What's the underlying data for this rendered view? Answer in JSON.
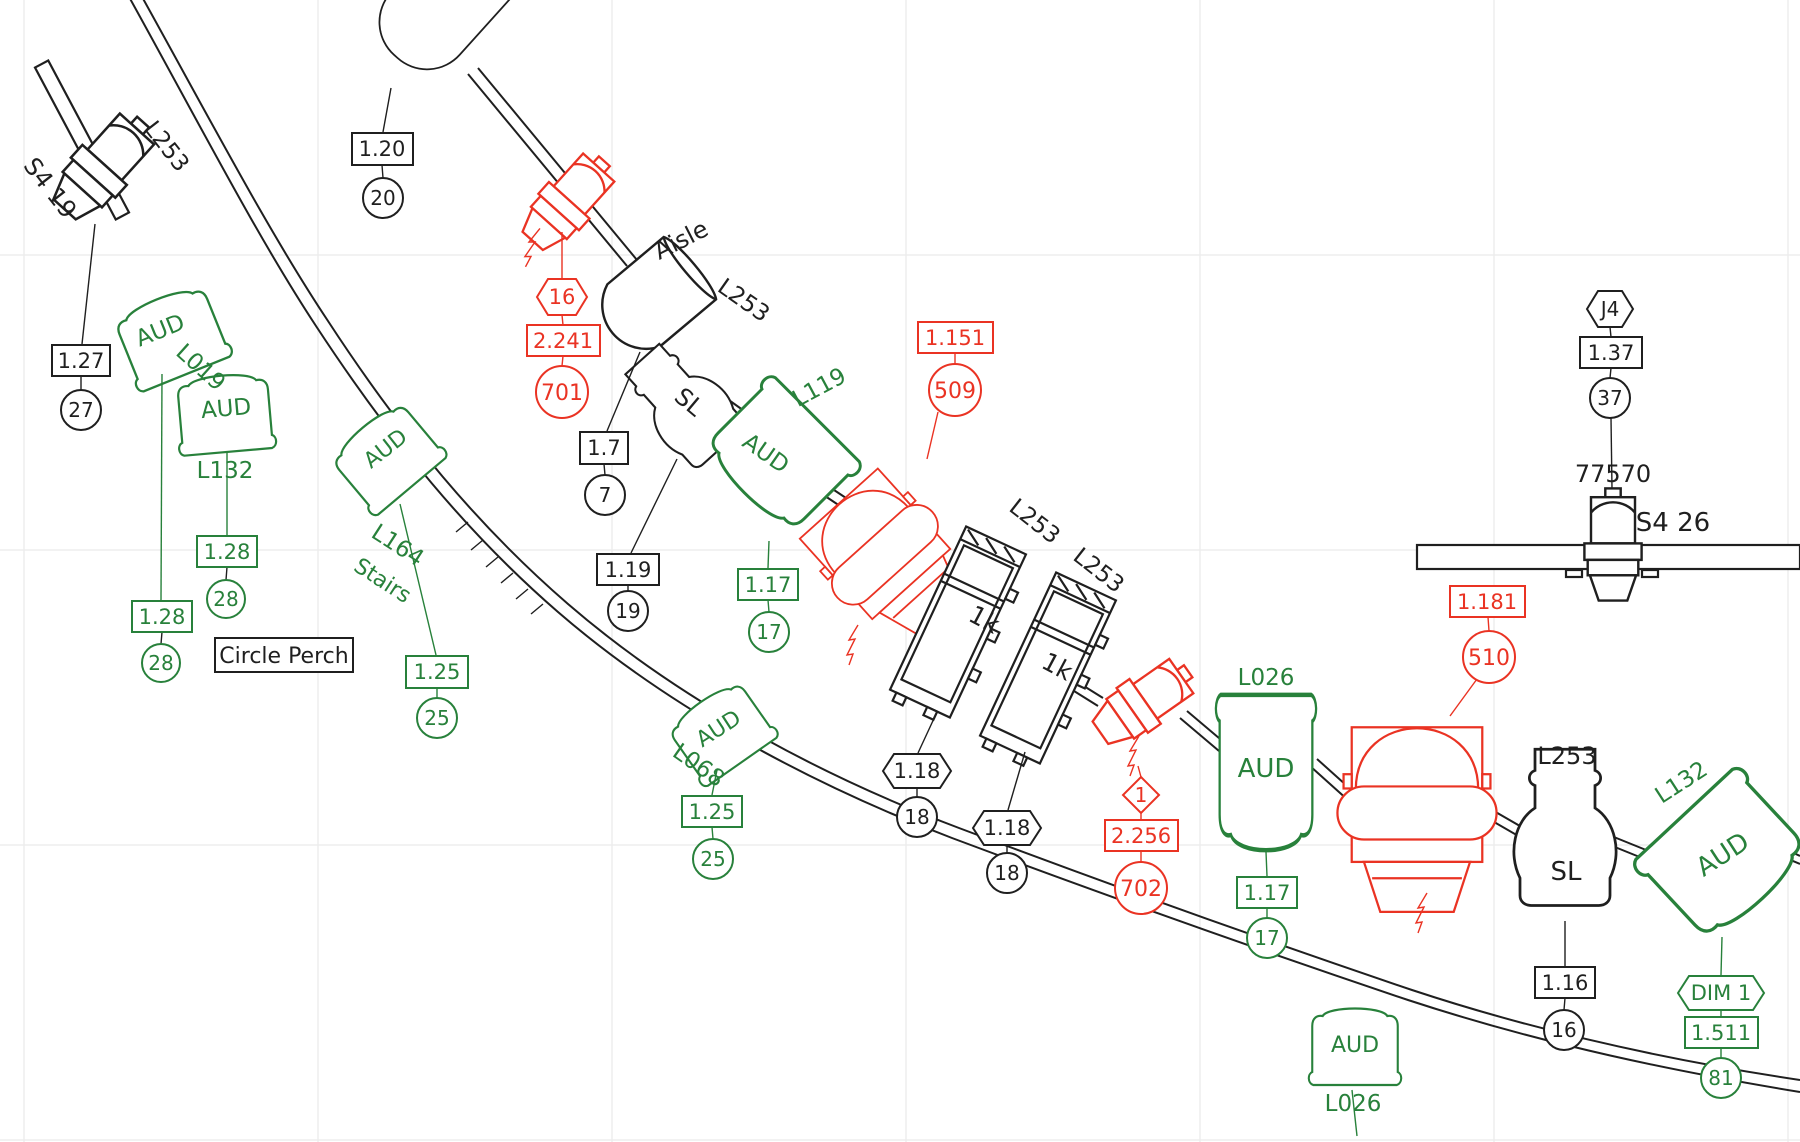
{
  "colors": {
    "background": "#ffffff",
    "black_linework": "#1f1f1f",
    "green_fixtures": "#28813b",
    "red_fixtures": "#ea3323",
    "grid": "#ededed"
  },
  "annotations": {
    "circle_perch": "Circle Perch",
    "aisle": "Aisle"
  },
  "fixtures": {
    "s4_19": {
      "label": "S4 19",
      "gel": "L253",
      "channel": "1.27",
      "unit": "27"
    },
    "spot_top": {
      "channel": "1.20",
      "unit": "20"
    },
    "aud_l019": {
      "type": "AUD",
      "position": "L019",
      "channel": "1.28",
      "unit": "28"
    },
    "aud_l132_left": {
      "type": "AUD",
      "position": "L132",
      "channel": "1.28",
      "unit": "28"
    },
    "aud_l164": {
      "type": "AUD",
      "position_line1": "L164",
      "position_line2": "Stairs",
      "channel": "1.25",
      "unit": "25"
    },
    "aud_l068": {
      "type": "AUD",
      "position": "L068",
      "channel": "1.25",
      "unit": "25"
    },
    "aud_l119": {
      "type": "AUD",
      "position": "L119",
      "channel": "1.17",
      "unit": "17"
    },
    "aud_l026_right": {
      "type": "AUD",
      "position": "L026",
      "channel": "1.17",
      "unit": "17"
    },
    "aud_l026_bottom": {
      "type": "AUD",
      "position": "L026"
    },
    "aud_l132_right": {
      "type": "AUD",
      "position": "L132",
      "dimmer": "DIM 1",
      "channel": "1.511",
      "unit": "81"
    },
    "red_701": {
      "dimmer": "16",
      "channel": "2.241",
      "unit": "701"
    },
    "red_702": {
      "dimmer": "1",
      "channel": "2.256",
      "unit": "702"
    },
    "mover_509": {
      "channel": "1.151",
      "unit": "509"
    },
    "mover_510": {
      "channel": "1.181",
      "unit": "510"
    },
    "sl_aisle": {
      "gel": "L253",
      "type": "SL",
      "channel_a": "1.7",
      "unit_a": "7",
      "channel_b": "1.19",
      "unit_b": "19"
    },
    "onek_a": {
      "gel": "L253",
      "wattage": "1k",
      "channel": "1.18",
      "unit": "18"
    },
    "onek_b": {
      "gel": "L253",
      "wattage": "1k",
      "channel": "1.18",
      "unit": "18"
    },
    "sl_right": {
      "gel": "L253",
      "type": "SL",
      "channel": "1.16",
      "unit": "16"
    },
    "s4_26": {
      "label": "S4 26",
      "unit_number": "77570",
      "jack": "J4",
      "channel": "1.37",
      "unit": "37"
    }
  }
}
